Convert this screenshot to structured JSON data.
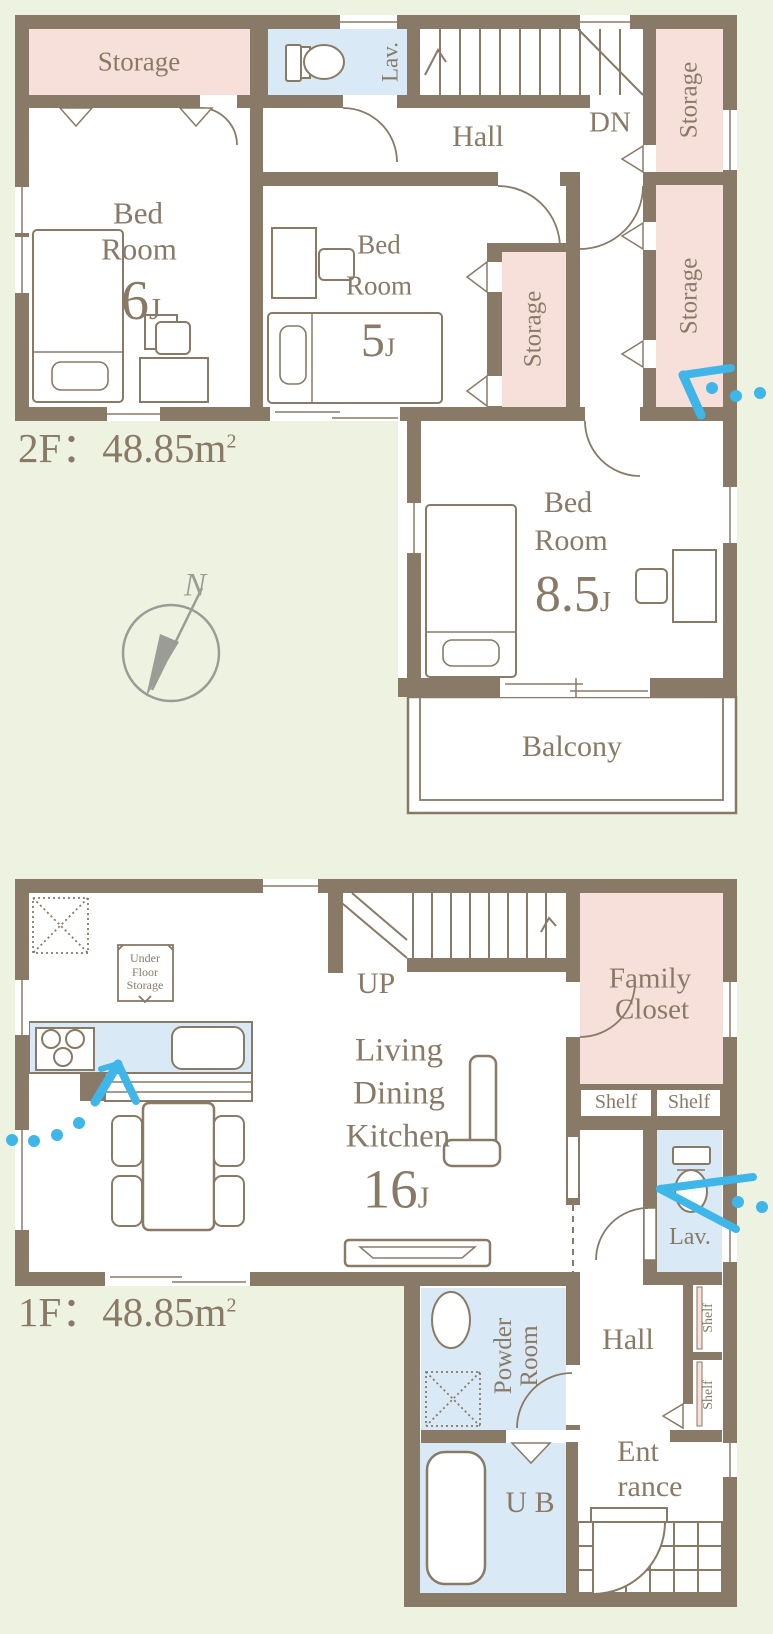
{
  "colors": {
    "background": "#eef2e1",
    "wall_and_text": "#897a67",
    "storage_pink": "#f8e0da",
    "wet_area_blue": "#d9eaf6",
    "entry_arrow_blue": "#3fb6e9",
    "compass_gray": "#9c9c96"
  },
  "f2": {
    "area_prefix": "2F：48.85m",
    "area_sup": "2",
    "storage_top_left": "Storage",
    "storage_top_right": "Storage",
    "storage_right": "Storage",
    "storage_mid": "Storage",
    "lav": "Lav.",
    "hall": "Hall",
    "dn": "DN",
    "bed1": {
      "name1": "Bed",
      "name2": "Room",
      "size": "6",
      "unit": "J"
    },
    "bed2": {
      "name1": "Bed",
      "name2": "Room",
      "size": "5",
      "unit": "J"
    },
    "bed3": {
      "name1": "Bed",
      "name2": "Room",
      "size": "8.5",
      "unit": "J"
    },
    "balcony": "Balcony",
    "compass_n": "N"
  },
  "f1": {
    "area_prefix": "1F：48.85m",
    "area_sup": "2",
    "underfloor": {
      "l1": "Under",
      "l2": "Floor",
      "l3": "Storage"
    },
    "up": "UP",
    "ldk": {
      "l1": "Living",
      "l2": "Dining",
      "l3": "Kitchen",
      "size": "16",
      "unit": "J"
    },
    "family_closet": {
      "l1": "Family",
      "l2": "Closet"
    },
    "shelf_left": "Shelf",
    "shelf_right": "Shelf",
    "shelf_v1": "Shelf",
    "shelf_v2": "Shelf",
    "lav": "Lav.",
    "hall": "Hall",
    "powder": {
      "l1": "Powder",
      "l2": "Room"
    },
    "ub": "U B",
    "entrance": {
      "l1": "Ent",
      "l2": "rance"
    }
  }
}
